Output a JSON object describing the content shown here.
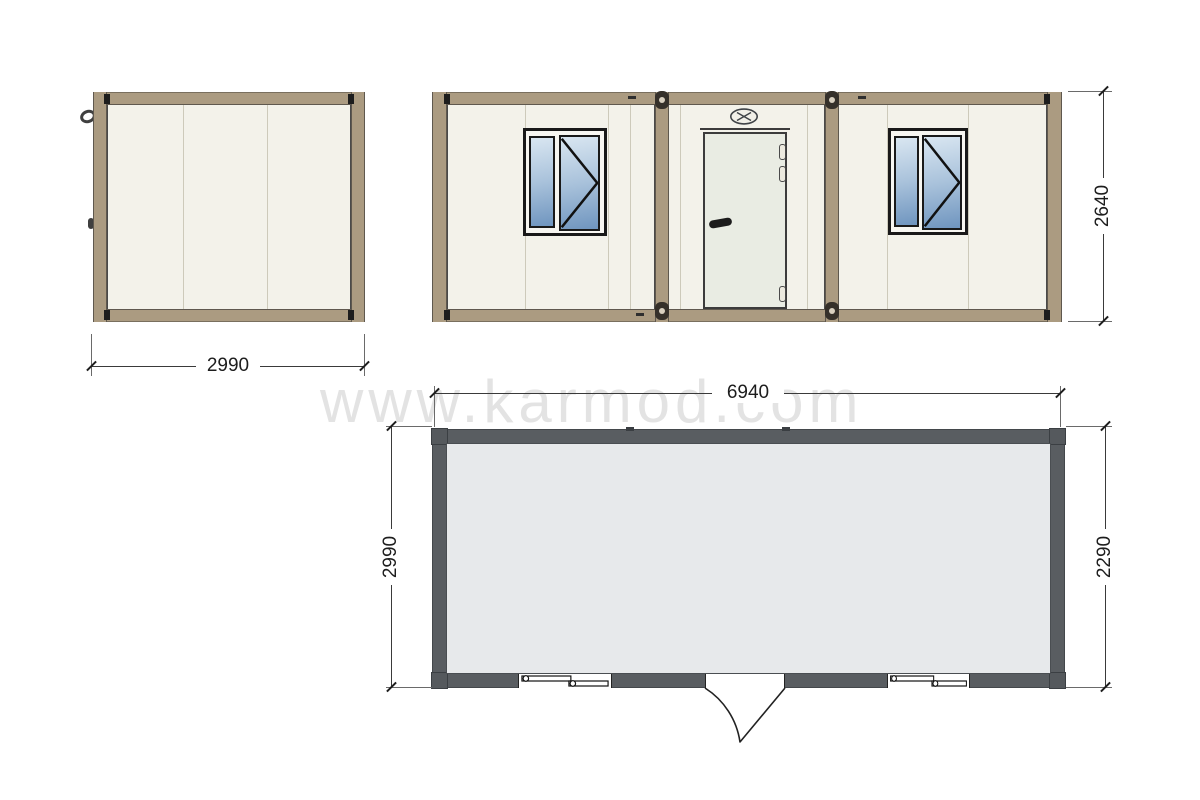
{
  "watermark": "www.karmod.com",
  "dimensions": {
    "side_width": "2990",
    "elevation_height": "2640",
    "plan_width": "6940",
    "plan_depth": "2990",
    "plan_inner_depth": "2290"
  },
  "icons": {
    "vent": "vent-icon",
    "casement": "casement-opening-lines",
    "twist_lock": "twist-lock-connector",
    "hook": "wall-hook"
  },
  "colors": {
    "frame_tan": "#ab9b81",
    "wall_panel": "#f3f2ea",
    "panel_seam": "#cdcaba",
    "window_frame": "#191919",
    "glass_top": "#d9e6f1",
    "glass_bottom": "#6f95bf",
    "door": "#e9ece3",
    "plan_wall": "#595d61",
    "plan_floor": "#e7e9eb",
    "dimension_text": "#1d1d1d",
    "watermark": "#e3e3e3"
  }
}
